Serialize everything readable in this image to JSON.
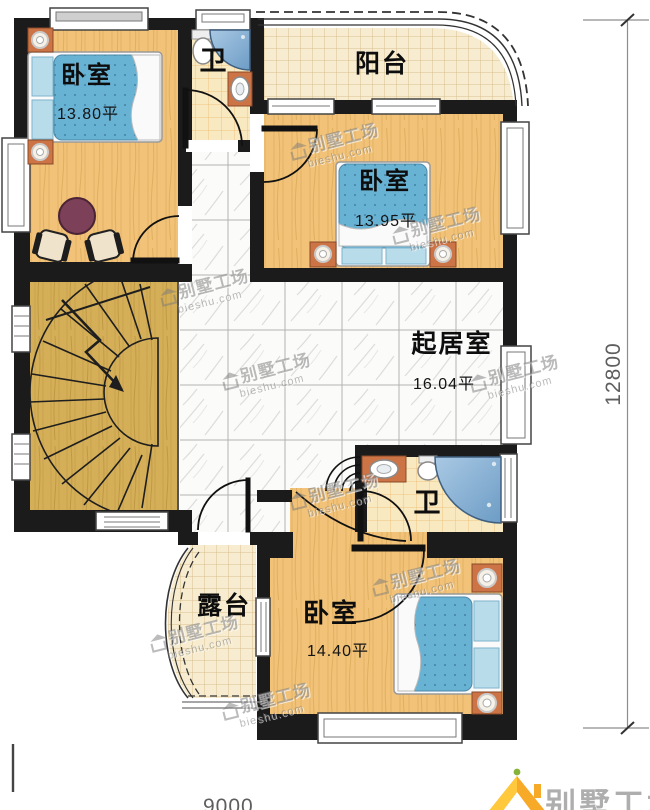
{
  "rooms": {
    "bedroom_top_left": {
      "label": "卧室",
      "area": "13.80平"
    },
    "bedroom_middle": {
      "label": "卧室",
      "area": "13.95平"
    },
    "bedroom_bottom": {
      "label": "卧室",
      "area": "14.40平"
    },
    "living_room": {
      "label": "起居室",
      "area": "16.04平"
    },
    "bathroom_top": {
      "label": "卫"
    },
    "bathroom_bottom": {
      "label": "卫"
    },
    "balcony": {
      "label": "阳台"
    },
    "terrace": {
      "label": "露台"
    }
  },
  "dimensions": {
    "right_height": "12800",
    "bottom_width": "9000"
  },
  "watermark": {
    "brand": "别墅工场",
    "site": "bieshu.com"
  },
  "logo": {
    "brand": "别墅工场"
  },
  "colors": {
    "wall": "#1b1b1b",
    "wood_floor": "#f1c277",
    "stair_floor": "#d5af58",
    "bed_blue": "#68b2d4",
    "furniture_orange": "#cd7446",
    "tub_blue": "#86aed2",
    "logo_orange": "#f7a928"
  }
}
